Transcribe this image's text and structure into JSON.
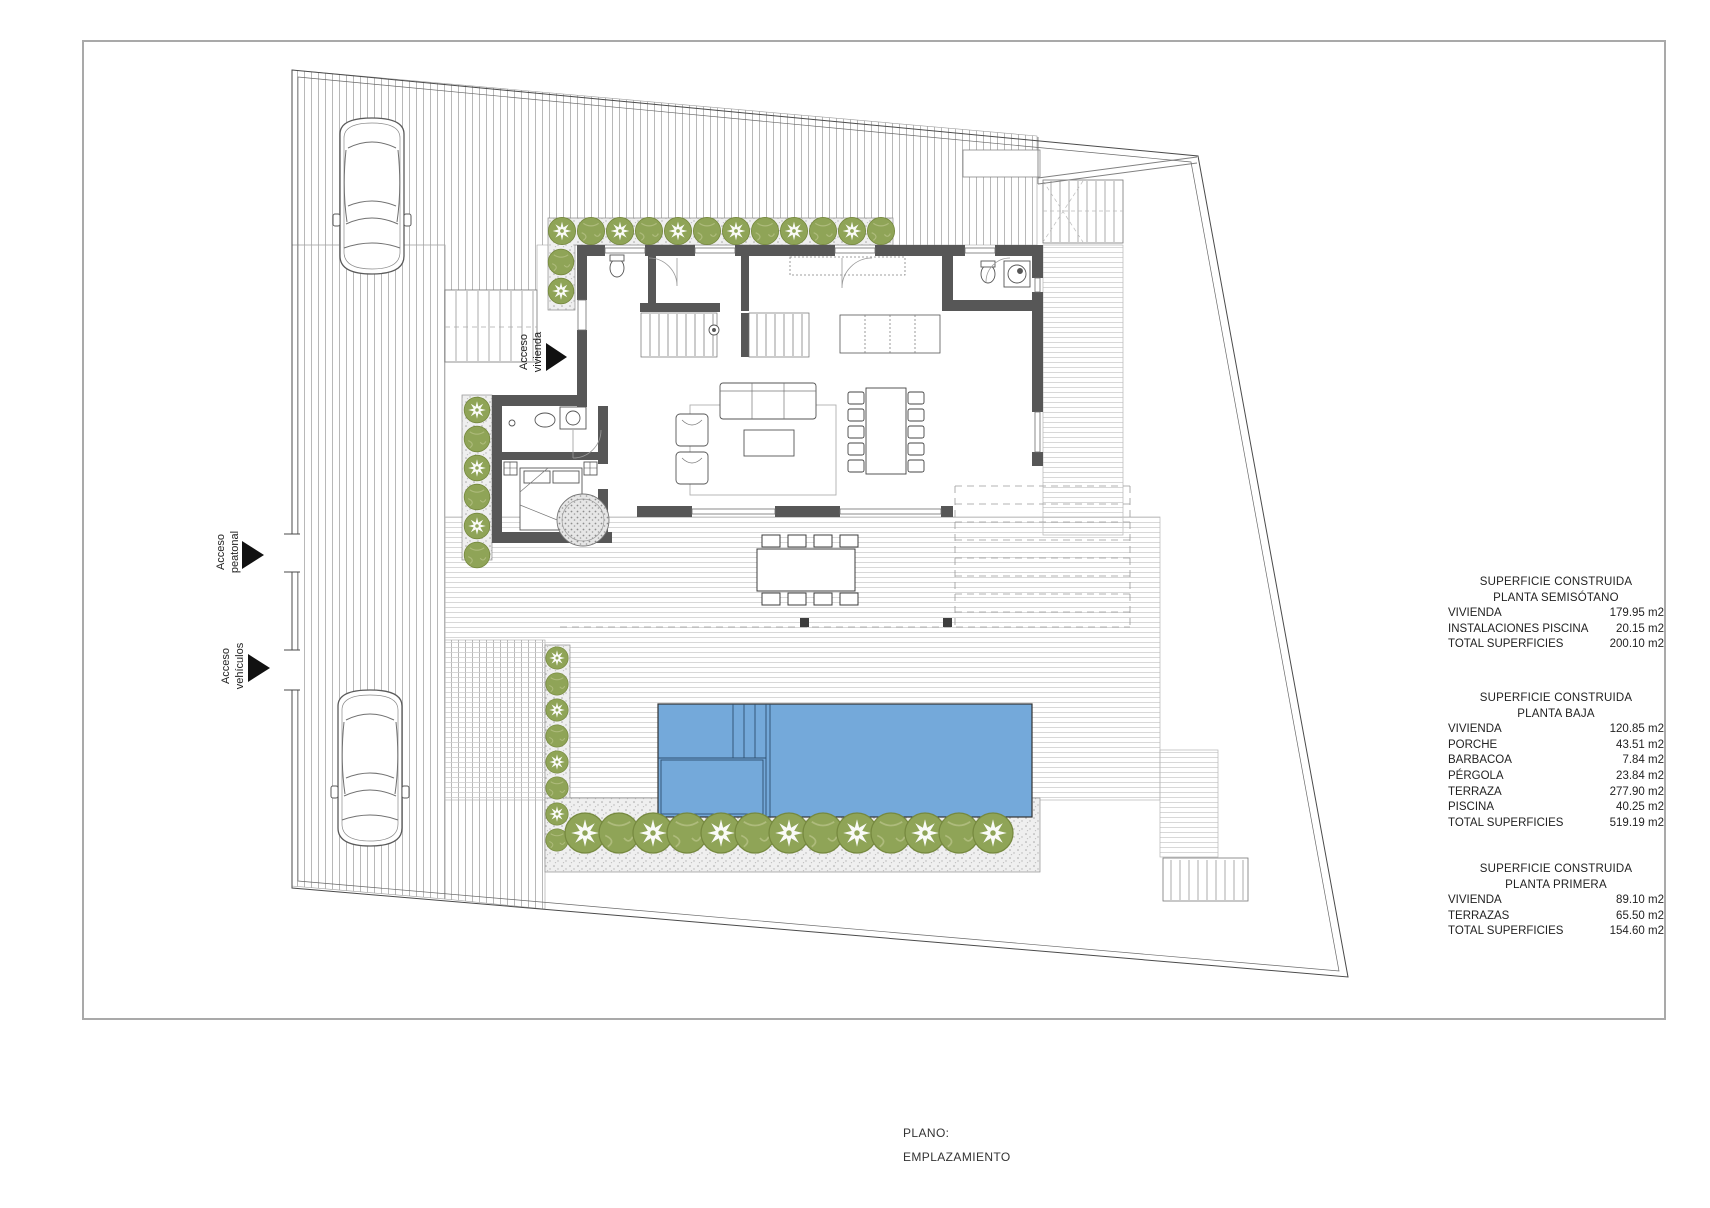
{
  "drawing": {
    "access_labels": {
      "pedestrian": {
        "line1": "Acceso",
        "line2": "peatonal"
      },
      "vehicles": {
        "line1": "Acceso",
        "line2": "vehículos"
      },
      "dwelling": {
        "line1": "Acceso",
        "line2": "vivienda"
      }
    },
    "title_block": {
      "label": "PLANO:",
      "value": "EMPLAZAMIENTO"
    },
    "colors": {
      "pool": "#74a9da",
      "tree": "#8fa457",
      "walls": "#575757",
      "boundary": "#4a4a4a",
      "paving_hatch": "#b4b4b4",
      "deck_lines": "#cfcfcf"
    }
  },
  "area_tables": [
    {
      "title": "SUPERFICIE CONSTRUIDA",
      "subtitle": "PLANTA SEMISÓTANO",
      "rows": [
        {
          "label": "VIVIENDA",
          "value": "179.95 m2"
        },
        {
          "label": "INSTALACIONES PISCINA",
          "value": "20.15 m2"
        },
        {
          "label": "TOTAL SUPERFICIES",
          "value": "200.10 m2"
        }
      ]
    },
    {
      "title": "SUPERFICIE CONSTRUIDA",
      "subtitle": "PLANTA BAJA",
      "rows": [
        {
          "label": "VIVIENDA",
          "value": "120.85 m2"
        },
        {
          "label": "PORCHE",
          "value": "43.51 m2"
        },
        {
          "label": "BARBACOA",
          "value": "7.84 m2"
        },
        {
          "label": "PÉRGOLA",
          "value": "23.84 m2"
        },
        {
          "label": "TERRAZA",
          "value": "277.90 m2"
        },
        {
          "label": "PISCINA",
          "value": "40.25 m2"
        },
        {
          "label": "TOTAL SUPERFICIES",
          "value": "519.19 m2"
        }
      ]
    },
    {
      "title": "SUPERFICIE CONSTRUIDA",
      "subtitle": "PLANTA PRIMERA",
      "rows": [
        {
          "label": "VIVIENDA",
          "value": "89.10 m2"
        },
        {
          "label": "TERRAZAS",
          "value": "65.50 m2"
        },
        {
          "label": "TOTAL SUPERFICIES",
          "value": "154.60 m2"
        }
      ]
    }
  ]
}
